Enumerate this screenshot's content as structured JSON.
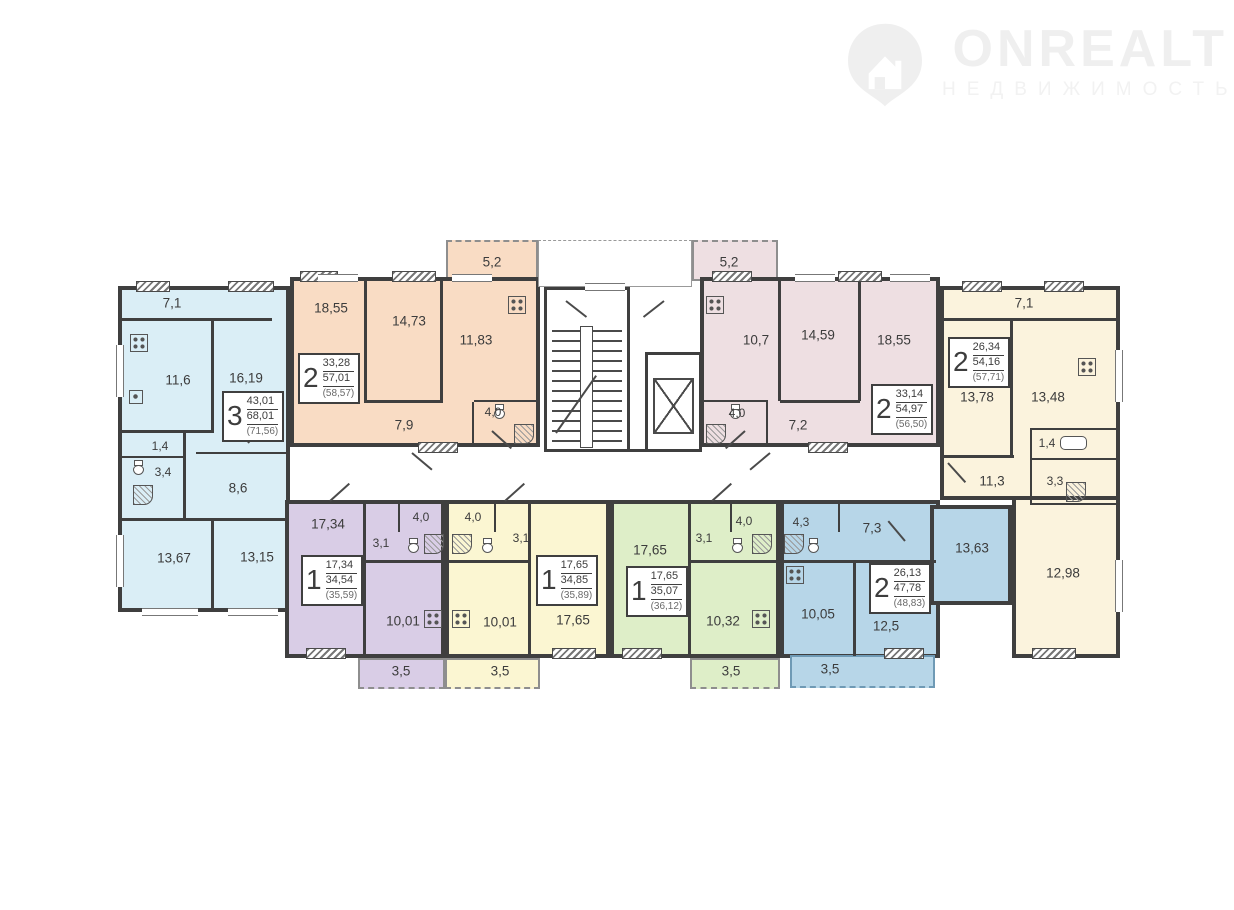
{
  "watermark": {
    "brand": "ONREALT",
    "subtitle": "НЕДВИЖИМОСТЬ",
    "icon": "house-pin-icon",
    "color": "#efefef"
  },
  "plan": {
    "wall_color": "#3f3f3f",
    "apartments": [
      {
        "name": "3-room-apartment-blue",
        "color": "#daeef6",
        "count": "3",
        "living": "43,01",
        "total": "68,01",
        "with_balcony": "(71,56)",
        "areas": [
          "7,1",
          "11,6",
          "16,19",
          "1,4",
          "3,4",
          "8,6",
          "13,67",
          "13,15"
        ]
      },
      {
        "name": "2-room-apartment-salmon",
        "color": "#f9dcc4",
        "count": "2",
        "living": "33,28",
        "total": "57,01",
        "with_balcony": "(58,57)",
        "areas": [
          "5,2",
          "18,55",
          "14,73",
          "11,83",
          "4,0",
          "7,9"
        ]
      },
      {
        "name": "2-room-apartment-mauve",
        "color": "#eedfe2",
        "count": "2",
        "living": "33,14",
        "total": "54,97",
        "with_balcony": "(56,50)",
        "areas": [
          "5,2",
          "10,7",
          "14,59",
          "18,55",
          "4,0",
          "7,2"
        ]
      },
      {
        "name": "2-room-apartment-cream",
        "color": "#fbf3dd",
        "count": "2",
        "living": "26,34",
        "total": "54,16",
        "with_balcony": "(57,71)",
        "areas": [
          "7,1",
          "13,78",
          "13,48",
          "1,4",
          "11,3",
          "3,3",
          "12,98"
        ]
      },
      {
        "name": "1-room-apartment-purple",
        "color": "#d9cde6",
        "count": "1",
        "living": "17,34",
        "total": "34,54",
        "with_balcony": "(35,59)",
        "areas": [
          "17,34",
          "3,1",
          "4,0",
          "10,01",
          "3,5"
        ]
      },
      {
        "name": "1-room-apartment-yellow",
        "color": "#fbf6d2",
        "count": "1",
        "living": "17,65",
        "total": "34,85",
        "with_balcony": "(35,89)",
        "areas": [
          "4,0",
          "3,1",
          "10,01",
          "17,65",
          "3,5"
        ]
      },
      {
        "name": "1-room-apartment-green",
        "color": "#deeec8",
        "count": "1",
        "living": "17,65",
        "total": "35,07",
        "with_balcony": "(36,12)",
        "areas": [
          "17,65",
          "3,1",
          "4,0",
          "10,32",
          "3,5"
        ]
      },
      {
        "name": "2-room-apartment-steelblue",
        "color": "#b7d6e8",
        "count": "2",
        "living": "26,13",
        "total": "47,78",
        "with_balcony": "(48,83)",
        "areas": [
          "4,3",
          "7,3",
          "13,63",
          "10,05",
          "12,5",
          "3,5"
        ]
      }
    ],
    "core": {
      "stairs": "stairs",
      "elevator": "elevator"
    }
  }
}
